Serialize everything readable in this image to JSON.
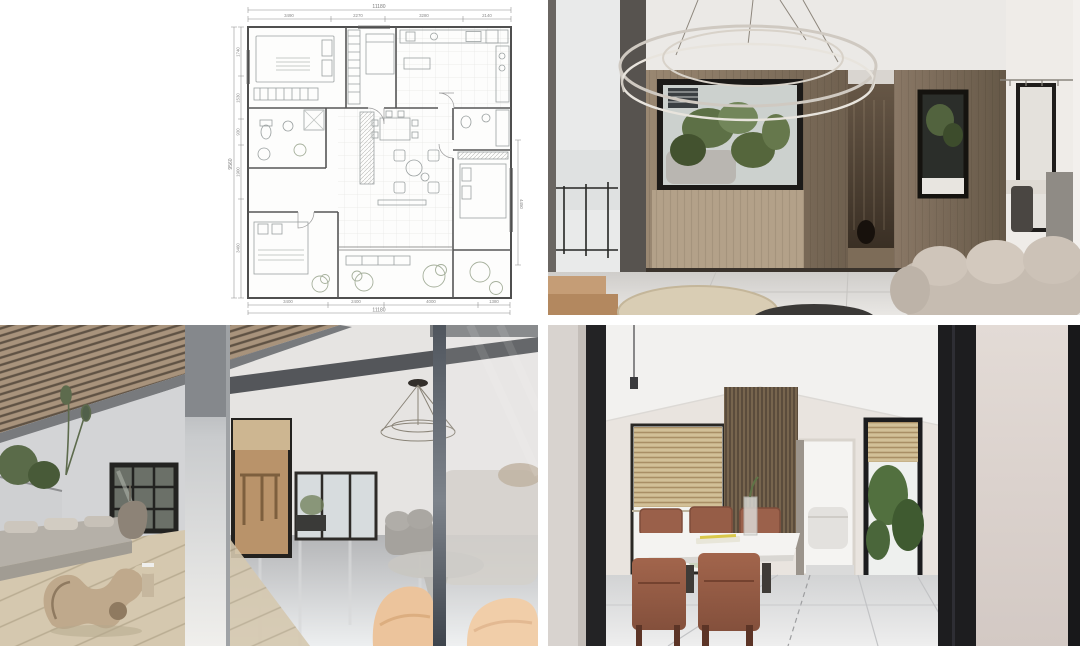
{
  "collage": {
    "description": "Apartment interior design presentation: floor plan with three rendered views",
    "grid": "2x2",
    "background": "#ffffff"
  },
  "panels": {
    "floor_plan": {
      "label": "floor-plan-drawing",
      "position": "top-left"
    },
    "living_room": {
      "label": "living-room-render-ring-chandelier",
      "position": "top-right"
    },
    "terrace": {
      "label": "terrace-render-wood-slat-ceiling",
      "position": "bottom-left"
    },
    "dining_room": {
      "label": "dining-room-render",
      "position": "bottom-right"
    }
  },
  "floor_plan": {
    "dim_top": {
      "total": "11180",
      "segments": [
        "3490",
        "2270",
        "3280",
        "2140"
      ]
    },
    "dim_bottom": {
      "total": "11180",
      "segments": [
        "3400",
        "2400",
        "4000",
        "1380"
      ]
    },
    "dim_left": {
      "total": "9560",
      "segments": [
        "1740",
        "1530",
        "930",
        "1900",
        "3460"
      ]
    },
    "dim_right": {
      "segments": [
        "4450"
      ]
    }
  },
  "colors": {
    "wood_wall": "#7c6c59",
    "slat_ceiling": "#a8947d",
    "deck": "#d5c8af",
    "marble_floor": "#dddbd8",
    "sofa_beige": "#c4bab0",
    "chair_terracotta": "#965e48",
    "frame_black": "#1e1d1b",
    "plant_green": "#5a6b46",
    "glass_gray": "#cdd2d2"
  }
}
